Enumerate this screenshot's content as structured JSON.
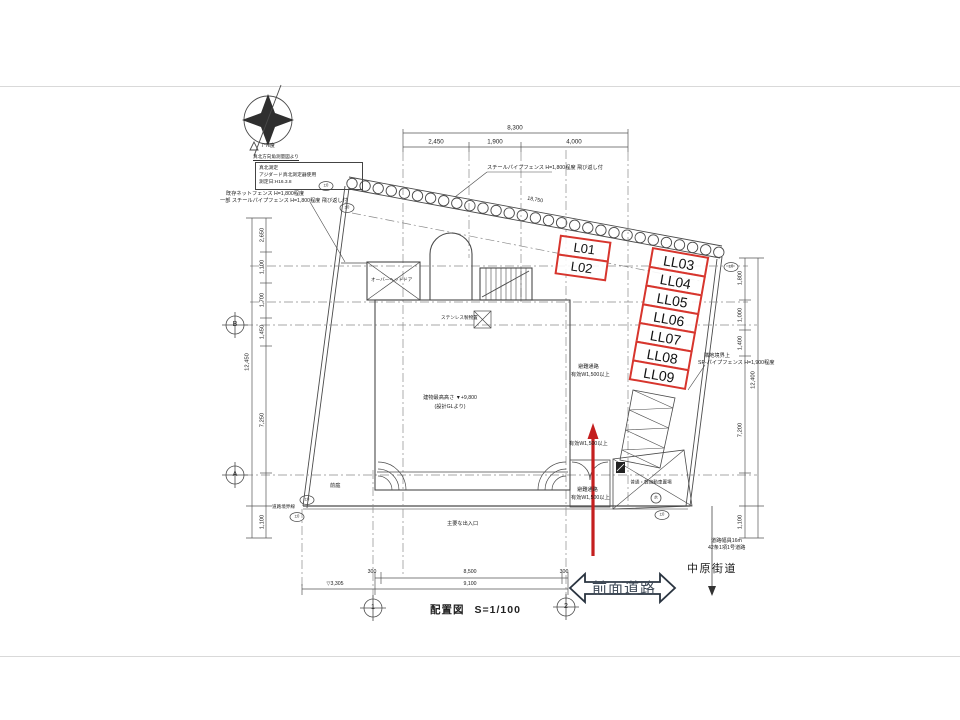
{
  "title_block": {
    "title": "配置図",
    "scale": "S=1/100"
  },
  "north_block": {
    "angle": "7°N度",
    "survey_note": "真北方向角測量図より",
    "box_line1": "真北測定",
    "box_line2": "アジダード真北測定器使用",
    "box_line3": "測定日:H16.3.8"
  },
  "parking": {
    "upper": [
      "L01",
      "L02"
    ],
    "right": [
      "LL03",
      "LL04",
      "LL05",
      "LL06",
      "LL07",
      "LL08",
      "LL09"
    ]
  },
  "roads": {
    "front": "前面道路",
    "avenue": "中原街道",
    "note1": "道路幅員16m",
    "note2": "42条1項1号道路"
  },
  "annotations": {
    "fence_top": "スチールパイプフェンス H=1,800程度 飛び返し付",
    "fence_left1": "既存ネットフェンス H=1,800程度",
    "fence_left2": "一部 スチールパイプフェンス H=1,800程度 飛び返し付",
    "fence_right1": "隣地境界上",
    "fence_right2": "SP-パイプフェンス H=1,900程度",
    "fence_length": "18,750",
    "escape_corridor": "避難通路",
    "effective_width": "有効W1,500以上",
    "parking_space": "普通・軽自動車置場",
    "overhead_door": "オーバーヘッドドア",
    "storage": "ステンレス製物置",
    "front_garden": "前庭",
    "main_entrance": "主要な出入口",
    "building_height": "建物最高高さ ▼+9,800",
    "building_height_ref": "(設計GLより)",
    "road_boundary": "道路境界線",
    "water": "水"
  },
  "dimensions": {
    "top_total": "8,300",
    "top_seg1": "2,450",
    "top_seg2": "1,900",
    "top_seg3": "4,000",
    "left_total": "12,450",
    "left_seg1": "2,650",
    "left_seg2": "1,100",
    "left_seg3": "1,700",
    "left_seg4": "1,450",
    "left_seg5": "7,250",
    "left_seg6": "1,100",
    "right_total": "12,400",
    "right_seg1": "1,800",
    "right_seg2": "1,000",
    "right_seg3": "1,400",
    "right_seg4": "7,200",
    "right_seg5": "1,100",
    "bottom_seg1": "300",
    "bottom_seg2": "8,500",
    "bottom_seg3": "300",
    "bottom_total": "9,100",
    "bottom_level": "▽3,305"
  },
  "bubbles": {
    "b": "B",
    "a": "A",
    "g1": "1",
    "g2": "2",
    "pm": "±0"
  },
  "colors": {
    "highlight_red": "#d7352d",
    "arrow_red": "#c41f1f",
    "line": "#4a4a4a"
  }
}
